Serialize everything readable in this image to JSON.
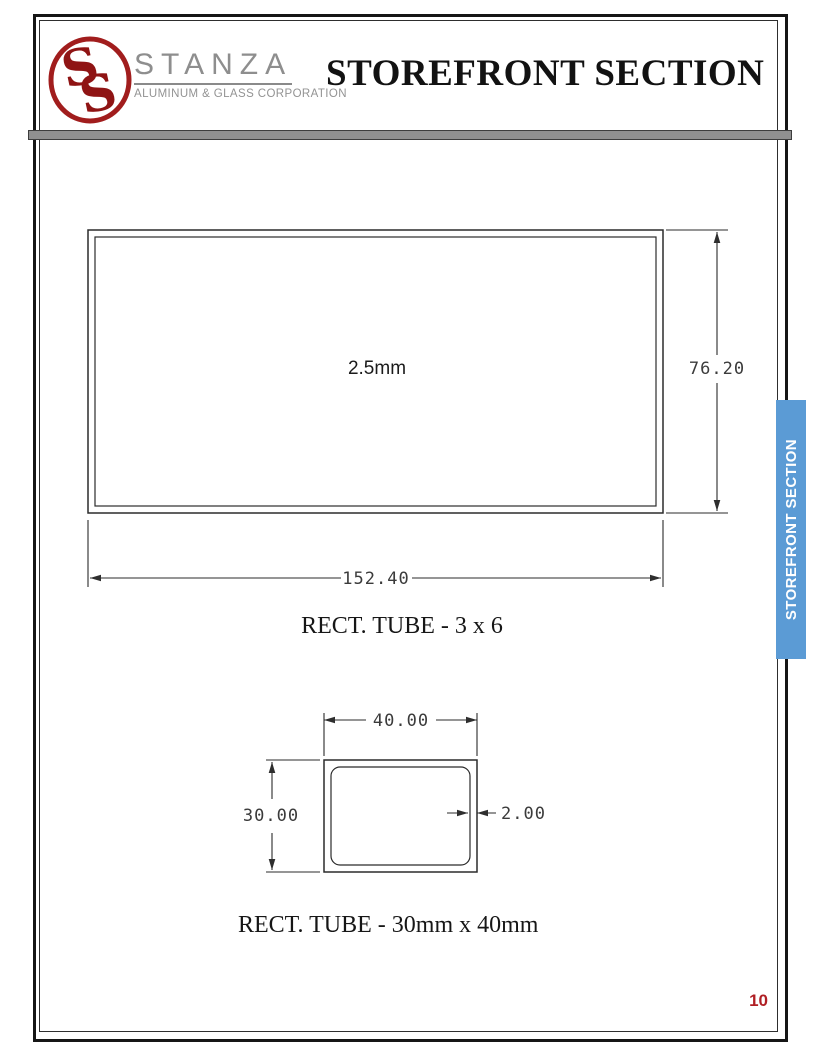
{
  "header": {
    "title": "STOREFRONT SECTION",
    "logo": {
      "monogram_letter_1": "S",
      "monogram_letter_2": "S",
      "name": "STANZA",
      "tagline": "ALUMINUM & GLASS CORPORATION"
    }
  },
  "side_tab": {
    "label": "STOREFRONT SECTION"
  },
  "page_number": "10",
  "drawings": [
    {
      "caption": "RECT. TUBE - 3 x 6",
      "wall_label": "2.5mm",
      "dim_height": "76.20",
      "dim_width": "152.40"
    },
    {
      "caption": "RECT. TUBE - 30mm x 40mm",
      "dim_width": "40.00",
      "dim_height": "30.00",
      "dim_thickness": "2.00"
    }
  ],
  "colors": {
    "tab_blue": "#5B9BD5",
    "logo_red": "#A11D1D",
    "monogram_red": "#8F1414",
    "page_number_red": "#B01F24",
    "divider_gray": "#8F8F8F",
    "stanza_gray": "#8E8E8E"
  }
}
